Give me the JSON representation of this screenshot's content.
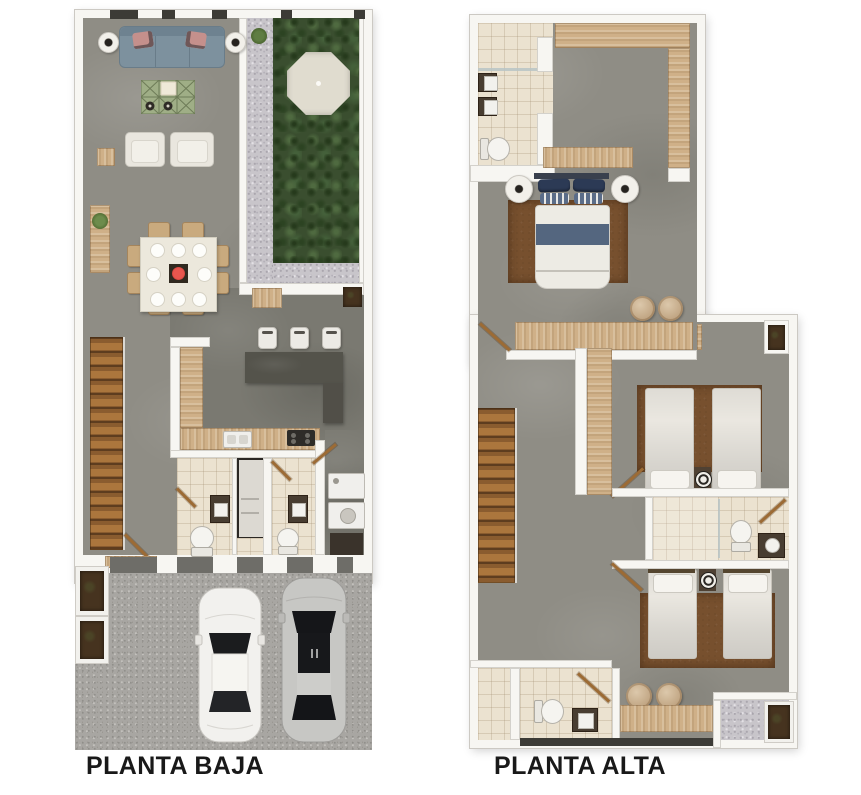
{
  "meta": {
    "canvas_width": 861,
    "canvas_height": 795,
    "background": "#ffffff",
    "type": "architectural-floor-plan"
  },
  "floors": [
    {
      "id": "planta-baja",
      "label": "PLANTA BAJA",
      "features": [
        "sofa",
        "lamp-side-tables",
        "coffee-table",
        "armchairs",
        "console-with-plant",
        "dining-table-8-seats",
        "garden-lawn",
        "gazebo",
        "gravel-path",
        "kitchen-l-counter",
        "kitchen-island-bar",
        "bar-stools",
        "sink",
        "stove",
        "staircase",
        "bathroom",
        "guest-bathroom",
        "utility-closet",
        "laundry-units",
        "entry-door",
        "garage-driveway",
        "white-car",
        "silver-car",
        "planter-boxes"
      ]
    },
    {
      "id": "planta-alta",
      "label": "PLANTA ALTA",
      "features": [
        "master-bathroom",
        "double-sinks",
        "shower",
        "toilet",
        "walk-in-closet",
        "dresser",
        "master-double-bed",
        "nightstand-lamps",
        "rug",
        "poufs",
        "study-desk",
        "corridor",
        "niche",
        "staircase",
        "wardrobe-strip",
        "bedroom2-twin-beds",
        "shared-bathroom",
        "bedroom3-twin-beds",
        "lower-bathroom",
        "storage-closet",
        "desk",
        "terrace",
        "planter"
      ]
    }
  ],
  "palette": {
    "wall": "#f7f6f2",
    "floor_concrete": "#8f8d85",
    "floor_concrete_dark": "#7a7971",
    "tile": "#ebe2d0",
    "wood_light": "#cfb088",
    "wood_stairs": "#8a5c2f",
    "sofa_blue": "#7d919e",
    "garden_green": "#3a4e2f",
    "gravel": "#c8c5ca",
    "driveway": "#a8a6a2",
    "rug_brown": "#77502e",
    "bed_blue_stripe": "#54667f",
    "pillow_navy": "#2c3a55",
    "island_dark": "#54534b",
    "soil_dark": "#46331f",
    "coffee_table_green": "#9fae86",
    "accent_red": "#cf2b25",
    "label_color": "#191919"
  }
}
